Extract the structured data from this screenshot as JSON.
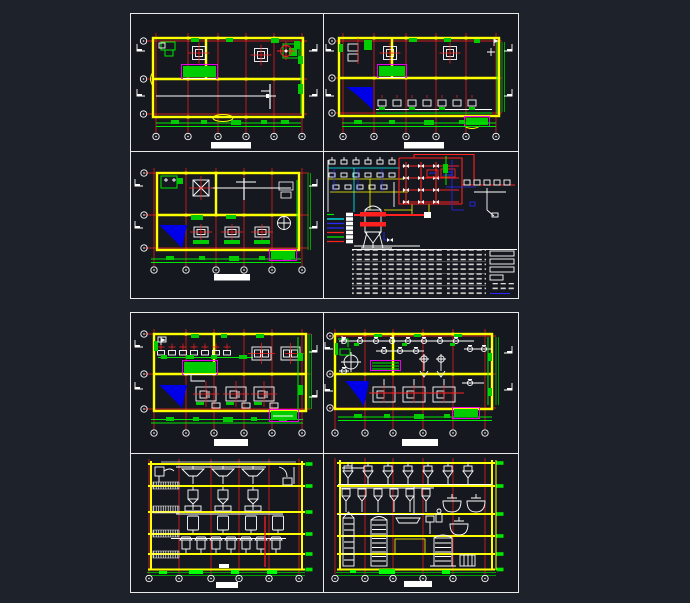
{
  "canvas": {
    "background": "#1e222a",
    "sheet_background": "#15181e",
    "frame_color": "#e9e9e9"
  },
  "palette": {
    "wall_yellow": "#ffff00",
    "grid_red": "#ff2020",
    "fixture_green": "#00e800",
    "equipment_white": "#ffffff",
    "stair_blue": "#0000e8",
    "highlight_magenta": "#ff00ff",
    "pipe_cyan": "#00ffff",
    "pipe_blue": "#2828ff"
  },
  "sheets": [
    {
      "name": "upper-sheet",
      "label": "Upper drawing sheet with three floor plans and a piping schematic",
      "panels": [
        {
          "name": "floor-plan-a",
          "type": "floor-plan",
          "label": "Floor plan, two hoist openings and target mark",
          "column_bubbles": 6,
          "row_bubbles": 3,
          "has_stair": false,
          "has_title_bar": true
        },
        {
          "name": "floor-plan-b",
          "type": "floor-plan",
          "label": "Floor plan with stair hatch and equipment row",
          "column_bubbles": 6,
          "row_bubbles": 3,
          "has_stair": true,
          "has_title_bar": true
        },
        {
          "name": "floor-plan-c",
          "type": "floor-plan",
          "label": "Floor plan with stair hatch and three crosshair units",
          "column_bubbles": 6,
          "row_bubbles": 3,
          "has_stair": true,
          "has_title_bar": true
        },
        {
          "name": "piping-schematic",
          "type": "process-flow-diagram",
          "label": "Process piping schematic with vessel, valve matrix, legend and schedule table",
          "legend_line_colors": [
            "#00e800",
            "#00ffff",
            "#2828ff",
            "#2828ff",
            "#ff2020",
            "#00e800",
            "#ff2020"
          ],
          "has_table": true,
          "has_title_bar": false
        }
      ]
    },
    {
      "name": "lower-sheet",
      "label": "Lower drawing sheet with two equipment plans and two building sections",
      "panels": [
        {
          "name": "floor-plan-d",
          "type": "floor-plan",
          "label": "Equipment plan, motor row and three large units",
          "column_bubbles": 6,
          "row_bubbles": 3,
          "has_stair": true,
          "has_title_bar": true
        },
        {
          "name": "equipment-plan",
          "type": "floor-plan",
          "label": "Equipment plan with pump line and twin hoppers",
          "column_bubbles": 6,
          "row_bubbles": 3,
          "has_stair": true,
          "has_title_bar": true
        },
        {
          "name": "section-a",
          "type": "section-elevation",
          "label": "Building section, vessels on five levels",
          "column_bubbles": 6,
          "floor_levels": 5,
          "has_title_bar": true
        },
        {
          "name": "section-b",
          "type": "section-elevation",
          "label": "Building section with columns, tanks and screen grid",
          "column_bubbles": 6,
          "floor_levels": 5,
          "has_title_bar": true
        }
      ]
    }
  ]
}
